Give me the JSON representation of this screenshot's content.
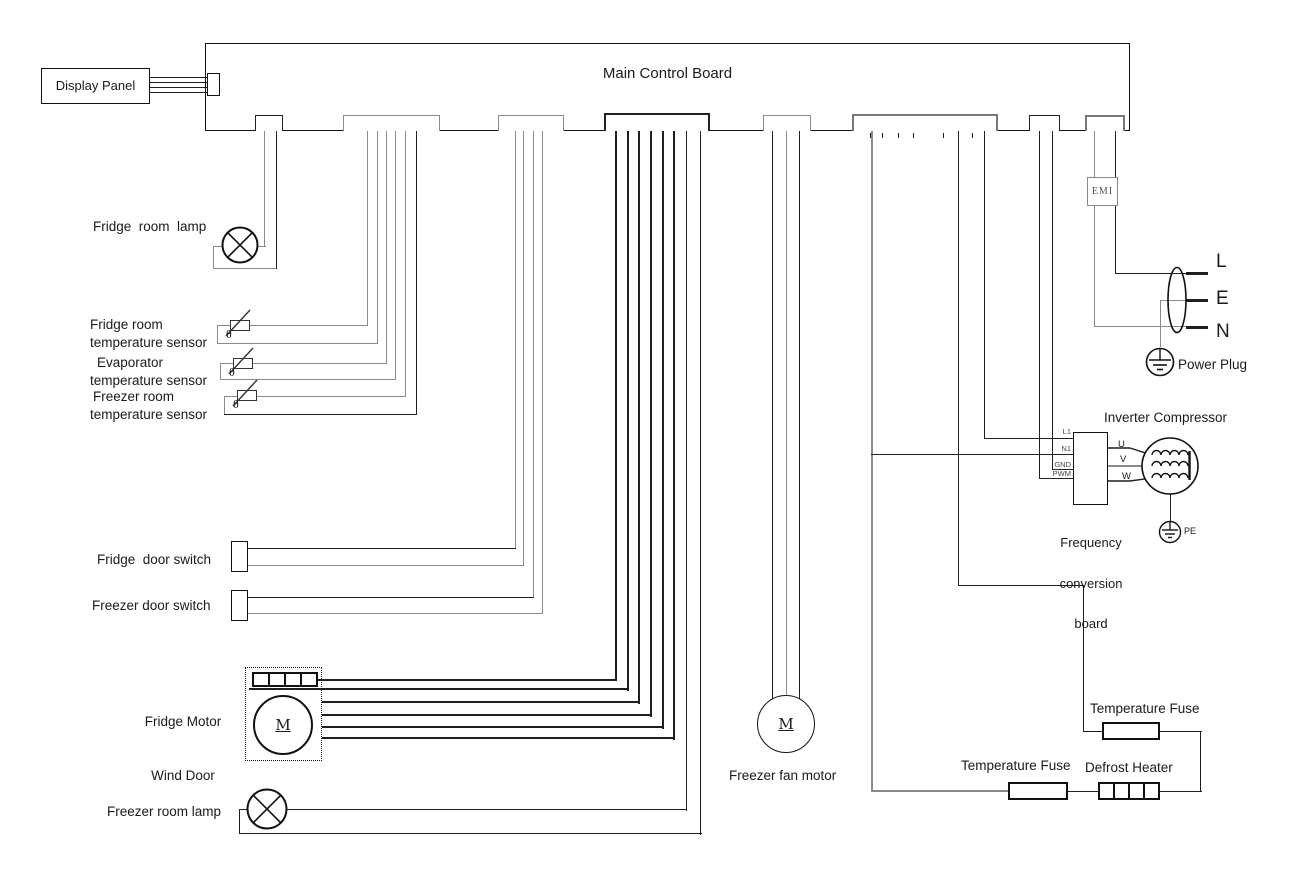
{
  "title": "Main Control Board",
  "display_panel": "Display Panel",
  "labels": {
    "fridge_room_lamp": "Fridge  room  lamp",
    "fridge_temp_sensor": [
      "Fridge room",
      "temperature sensor"
    ],
    "evap_temp_sensor": [
      "Evaporator",
      "temperature sensor"
    ],
    "freezer_temp_sensor": [
      "Freezer room",
      "temperature sensor"
    ],
    "fridge_door_switch": "Fridge  door switch",
    "freezer_door_switch": "Freezer door switch",
    "wind_door": [
      "Fridge Motor",
      "Wind Door"
    ],
    "freezer_room_lamp": "Freezer room lamp",
    "freezer_fan_motor": "Freezer fan motor"
  },
  "right": {
    "emi": "EMI",
    "plug_l": "L",
    "plug_e": "E",
    "plug_n": "N",
    "power_plug": "Power Plug",
    "inverter_compressor": "Inverter Compressor",
    "freq_board": [
      "Frequency",
      "conversion",
      "board"
    ],
    "pins": {
      "l1": "L1",
      "n1": "N1",
      "gnd": "GND",
      "pwm": "PWM"
    },
    "uvw": [
      "U",
      "V",
      "W"
    ],
    "pe": "PE",
    "temp_fuse_top": "Temperature Fuse",
    "temp_fuse_bottom": "Temperature Fuse",
    "defrost_heater": "Defrost Heater"
  },
  "symbols": {
    "motor": "M",
    "theta": "θ"
  },
  "colors": {
    "wire_gray": "#8a8a8a",
    "wire_black": "#1f1f1f"
  }
}
